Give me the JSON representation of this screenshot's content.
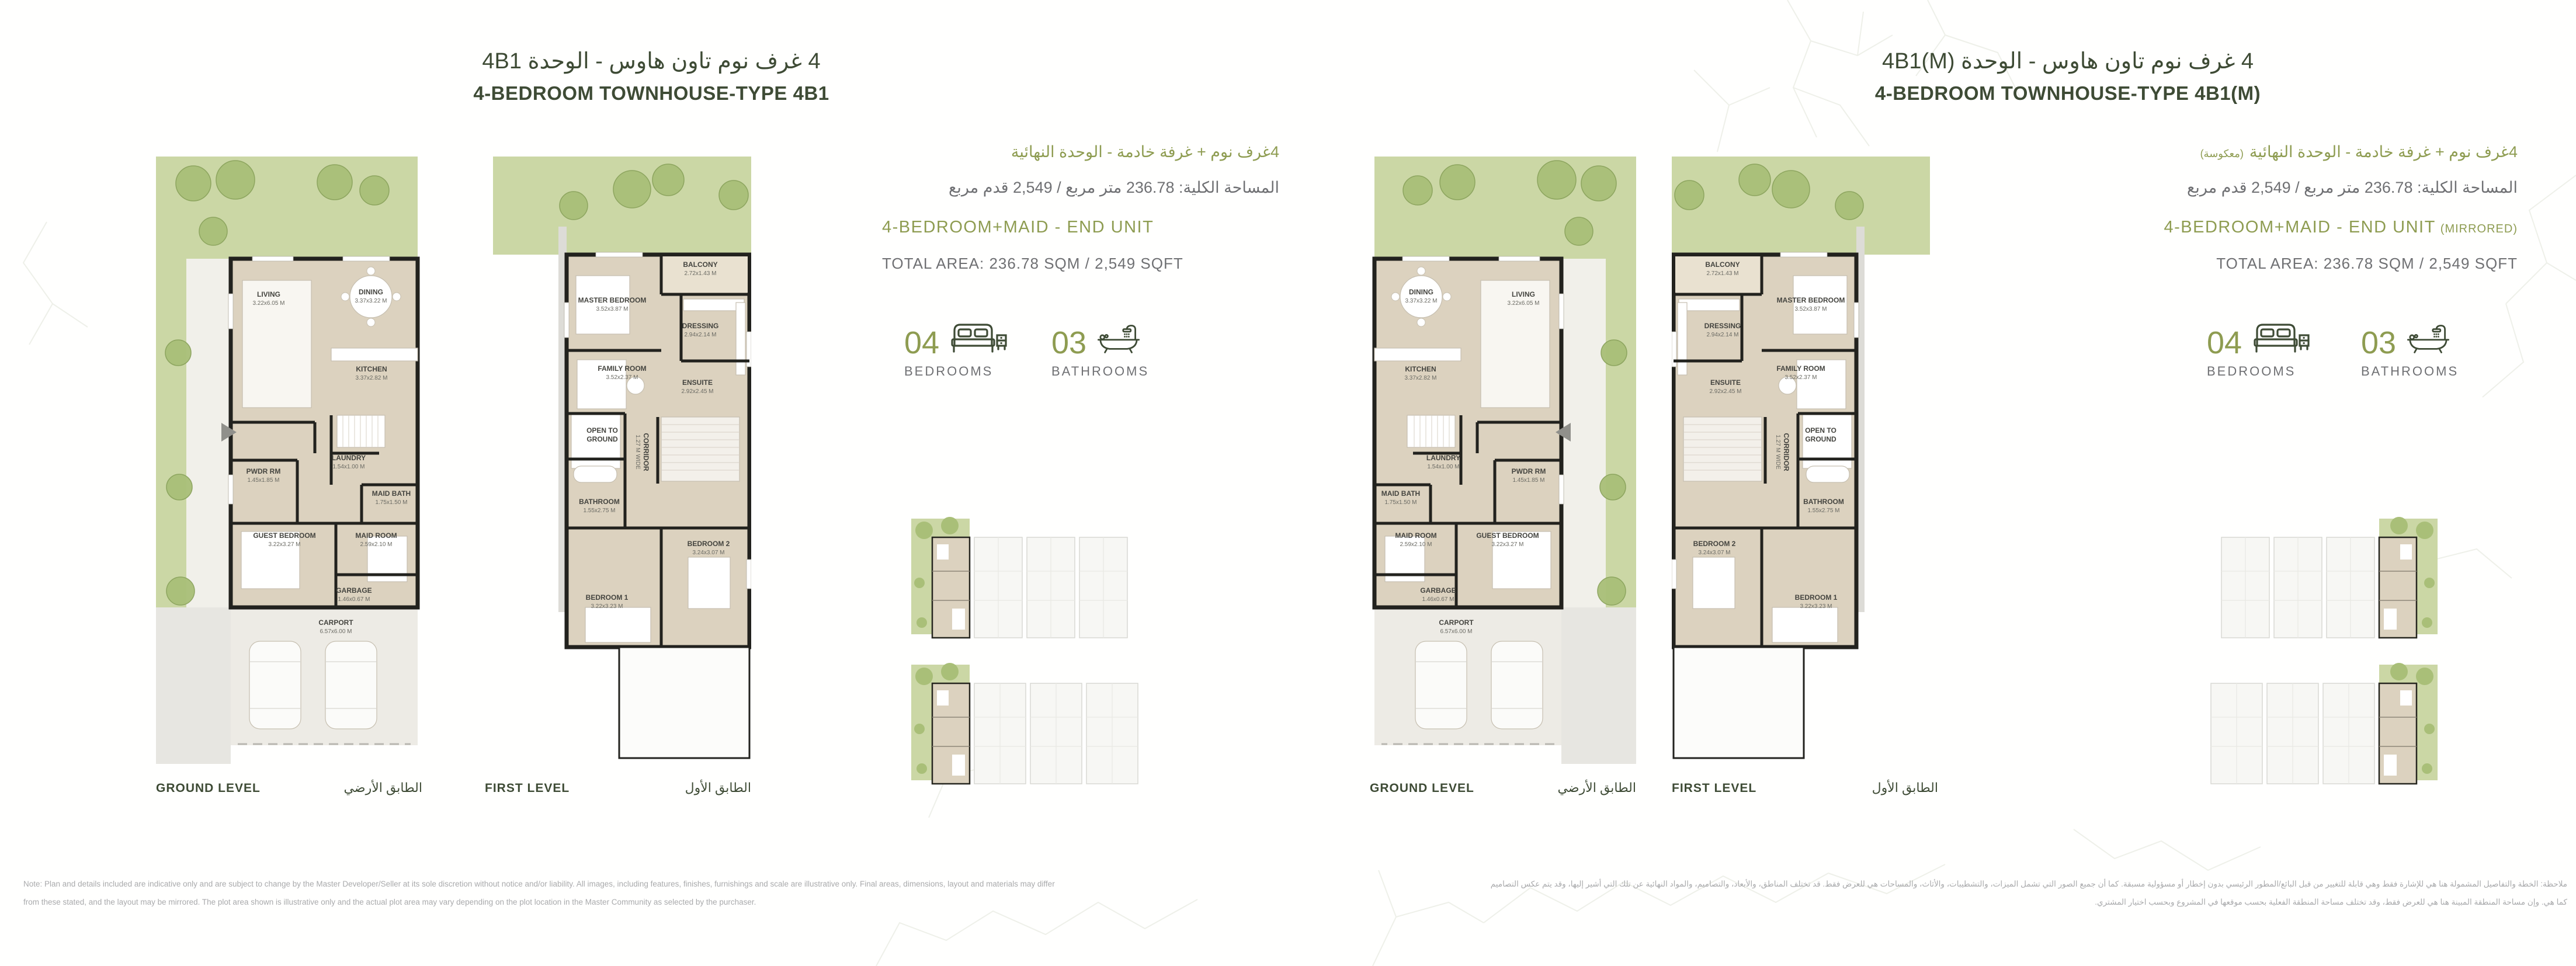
{
  "units": [
    {
      "title_ar": "4 غرف نوم تاون هاوس - الوحدة 4B1",
      "title_en": "4-BEDROOM TOWNHOUSE-TYPE 4B1",
      "subtitle_ar": "4غرف نوم + غرفة خادمة - الوحدة النهائية",
      "subtitle_ar_note": "",
      "area_ar": "المساحة الكلية: 236.78 متر مربع / 2,549 قدم مربع",
      "subtitle_en": "4-BEDROOM+MAID - END UNIT",
      "subtitle_en_note": "",
      "area_en": "TOTAL AREA: 236.78 SQM / 2,549 SQFT",
      "bedrooms_value": "04",
      "bedrooms_label": "BEDROOMS",
      "bathrooms_value": "03",
      "bathrooms_label": "BATHROOMS",
      "levels": [
        {
          "en": "GROUND LEVEL",
          "ar": "الطابق الأرضي"
        },
        {
          "en": "FIRST LEVEL",
          "ar": "الطابق الأول"
        }
      ]
    },
    {
      "title_ar": "4 غرف نوم تاون هاوس - الوحدة 4B1(M)",
      "title_en": "4-BEDROOM TOWNHOUSE-TYPE 4B1(M)",
      "subtitle_ar": "4غرف نوم + غرفة خادمة - الوحدة النهائية",
      "subtitle_ar_note": "(معكوسة)",
      "area_ar": "المساحة الكلية: 236.78 متر مربع / 2,549 قدم مربع",
      "subtitle_en": "4-BEDROOM+MAID - END UNIT",
      "subtitle_en_note": "(MIRRORED)",
      "area_en": "TOTAL AREA: 236.78 SQM / 2,549 SQFT",
      "bedrooms_value": "04",
      "bedrooms_label": "BEDROOMS",
      "bathrooms_value": "03",
      "bathrooms_label": "BATHROOMS",
      "levels": [
        {
          "en": "GROUND LEVEL",
          "ar": "الطابق الأرضي"
        },
        {
          "en": "FIRST LEVEL",
          "ar": "الطابق الأول"
        }
      ]
    }
  ],
  "plans": {
    "ground": {
      "rooms": {
        "living": {
          "name": "LIVING",
          "dims": "3.22x6.05 M"
        },
        "dining": {
          "name": "DINING",
          "dims": "3.37x3.22 M"
        },
        "kitchen": {
          "name": "KITCHEN",
          "dims": "3.37x2.82 M"
        },
        "laundry": {
          "name": "LAUNDRY",
          "dims": "1.54x1.00 M"
        },
        "pwdr": {
          "name": "PWDR RM",
          "dims": "1.45x1.85 M"
        },
        "maid_bath": {
          "name": "MAID BATH",
          "dims": "1.75x1.50 M"
        },
        "guest": {
          "name": "GUEST BEDROOM",
          "dims": "3.22x3.27 M"
        },
        "maid": {
          "name": "MAID ROOM",
          "dims": "2.59x2.10 M"
        },
        "garbage": {
          "name": "GARBAGE",
          "dims": "1.46x0.67 M"
        },
        "carport": {
          "name": "CARPORT",
          "dims": "6.57x6.00 M"
        }
      }
    },
    "first": {
      "rooms": {
        "balcony": {
          "name": "BALCONY",
          "dims": "2.72x1.43 M"
        },
        "master": {
          "name": "MASTER BEDROOM",
          "dims": "3.52x3.87 M"
        },
        "dressing": {
          "name": "DRESSING",
          "dims": "2.94x2.14 M"
        },
        "family": {
          "name": "FAMILY ROOM",
          "dims": "3.52x2.37 M"
        },
        "ensuite": {
          "name": "ENSUITE",
          "dims": "2.92x2.45 M"
        },
        "open": {
          "name": "OPEN TO GROUND",
          "dims": ""
        },
        "corridor": {
          "name": "CORRIDOR",
          "dims": "1.27 M WIDE"
        },
        "bathroom": {
          "name": "BATHROOM",
          "dims": "1.55x2.75 M"
        },
        "bed2": {
          "name": "BEDROOM 2",
          "dims": "3.24x3.07 M"
        },
        "bed1": {
          "name": "BEDROOM 1",
          "dims": "3.22x3.23 M"
        }
      }
    }
  },
  "footer": {
    "en_line1": "Note: Plan and details included are indicative only and are subject to change by the Master Developer/Seller at its sole discretion without notice and/or liability. All images, including features, finishes, furnishings and scale are illustrative only. Final areas, dimensions, layout and materials may differ",
    "en_line2": "from these stated, and the layout may be mirrored. The plot area shown is illustrative only and the actual plot area may vary depending on the plot location in the Master Community as selected by the purchaser.",
    "ar_line1": "ملاحظة: الخطة والتفاصيل المشمولة هنا هي للإشارة فقط وهي قابلة للتغيير من قبل البائع/المطور الرئيسي بدون إخطار أو مسؤولية مسبقة. كما أن جميع الصور التي تشمل الميزات، والتشطيبات، والأثاث، والمساحات هي للعرض فقط. قد تختلف المناطق، والأبعاد، والتصاميم، والمواد النهائية عن تلك التي أشير إليها، وقد يتم عكس التصاميم",
    "ar_line2": "كما هي. وإن مساحة المنطقة المبينة هنا هي للعرض فقط، وقد تختلف مساحة المنطقة الفعلية بحسب موقعها في المشروع وبحسب اختيار المشتري."
  },
  "colors": {
    "title_green": "#3e4b35",
    "olive_accent": "#8e9c51",
    "text_grey": "#6f7073",
    "footer_grey": "#a9aaac",
    "plan_beige": "#dcd2bf",
    "garden_green": "#cbd7a5",
    "tree_green": "#a9bf78",
    "wall_black": "#22221e"
  }
}
